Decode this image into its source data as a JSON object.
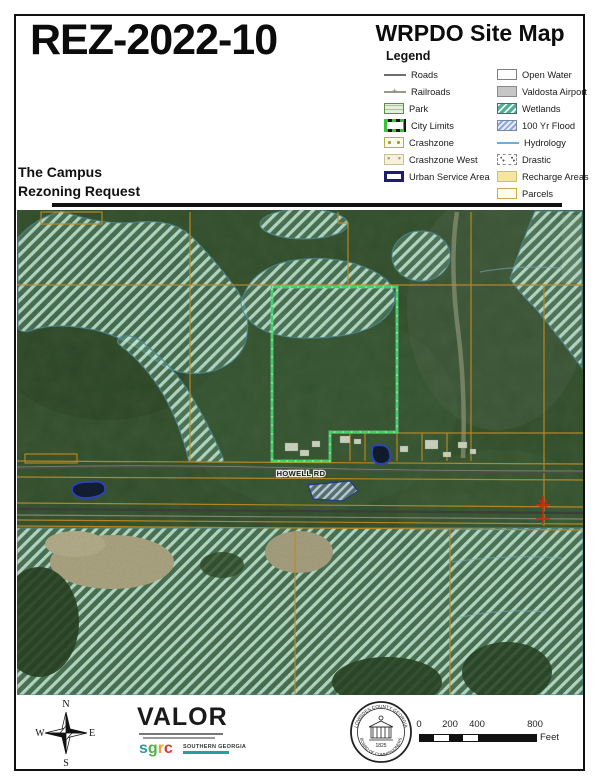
{
  "header": {
    "case_number": "REZ-2022-10",
    "map_title": "WRPDO Site Map",
    "legend_title": "Legend",
    "subtitle_line1": "The Campus",
    "subtitle_line2": "Rezoning Request"
  },
  "legend": {
    "left": [
      {
        "label": "Roads",
        "swatch": "road"
      },
      {
        "label": "Railroads",
        "swatch": "rail"
      },
      {
        "label": "Park",
        "swatch": "park"
      },
      {
        "label": "City Limits",
        "swatch": "citylimits"
      },
      {
        "label": "Crashzone",
        "swatch": "crashzone"
      },
      {
        "label": "Crashzone West",
        "swatch": "crashwest"
      },
      {
        "label": "Urban Service Area",
        "swatch": "usa"
      }
    ],
    "right": [
      {
        "label": "Open Water",
        "swatch": "water"
      },
      {
        "label": "Valdosta Airport",
        "swatch": "airport"
      },
      {
        "label": "Wetlands",
        "swatch": "wetlands"
      },
      {
        "label": "100 Yr Flood",
        "swatch": "flood"
      },
      {
        "label": "Hydrology",
        "swatch": "hydro"
      },
      {
        "label": "Drastic",
        "swatch": "drastic"
      },
      {
        "label": "Recharge Areas",
        "swatch": "recharge"
      },
      {
        "label": "Parcels",
        "swatch": "parcels"
      }
    ]
  },
  "map": {
    "road_label": "HOWELL RD"
  },
  "footer": {
    "valor": "VALOR",
    "sgrc_letters": [
      {
        "ch": "s",
        "color": "#2a9d9f"
      },
      {
        "ch": "g",
        "color": "#55b047"
      },
      {
        "ch": "r",
        "color": "#f0a030"
      },
      {
        "ch": "c",
        "color": "#d93838"
      }
    ],
    "sgrc_org": "SOUTHERN GEORGIA",
    "seal_top": "LOWNDES COUNTY GEORGIA",
    "seal_bottom": "BOARD OF COMMISSIONERS",
    "seal_year": "1825",
    "compass": {
      "n": "N",
      "e": "E",
      "s": "S",
      "w": "W"
    },
    "scale": {
      "ticks": [
        "0",
        "200",
        "400",
        "800"
      ],
      "unit": "Feet"
    }
  },
  "colors": {
    "wetland_stripe": "#9fd8c6",
    "parcel_line": "#d19020",
    "subject_outline": "#3fe06f",
    "flood_hatch": "#6a85cc",
    "urban_service_border": "#1c1c72",
    "crossing_marker": "#dd2211"
  }
}
